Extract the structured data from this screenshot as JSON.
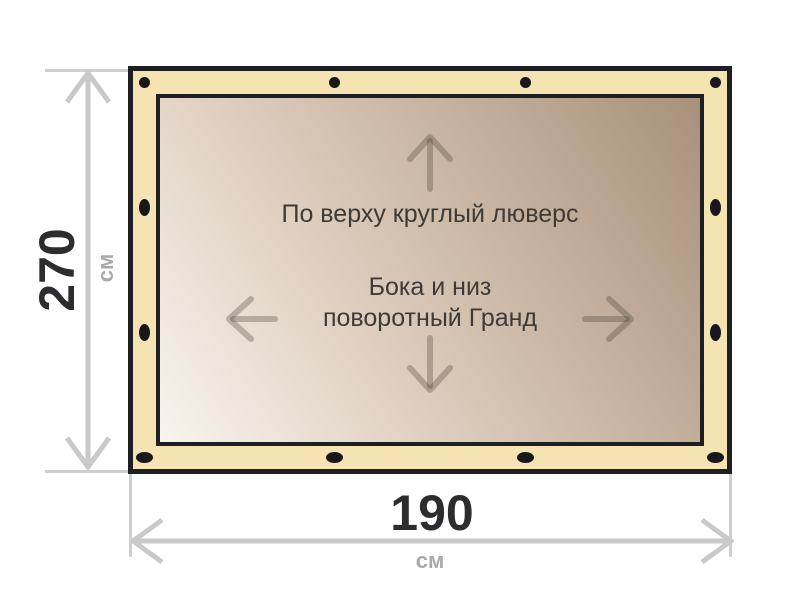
{
  "canvas_notes": {
    "top": "По верху круглый люверс",
    "middle_line1": "Бока и низ",
    "middle_line2": "поворотный Гранд"
  },
  "dimensions": {
    "height": {
      "value": "270",
      "unit": "см"
    },
    "width": {
      "value": "190",
      "unit": "см"
    }
  },
  "icons": {
    "grommet": "grommet-icon",
    "canvas_arrows": [
      "up-arrow-icon",
      "down-arrow-icon",
      "left-arrow-icon",
      "right-arrow-icon"
    ],
    "dimension_arrows": [
      "height-dimension-arrow-icon",
      "width-dimension-arrow-icon"
    ]
  },
  "colors": {
    "page_bg": "#ffffff",
    "frame_black": "#1e1f23",
    "hem_cream": "#f5e3b2",
    "grad_1": "#f8f4ee",
    "grad_2": "#e2d3c5",
    "grad_3": "#ccb9a7",
    "grad_4": "#a8917c",
    "grommet": "#18181c",
    "dim_line": "#c9c9c9",
    "ext_line": "#cfcfcf",
    "dim_text": "#2d2d30",
    "unit_text": "#a9a9a9",
    "note_text": "#3e3a36",
    "canvas_arrow": "rgba(74,64,54,0.32)"
  }
}
